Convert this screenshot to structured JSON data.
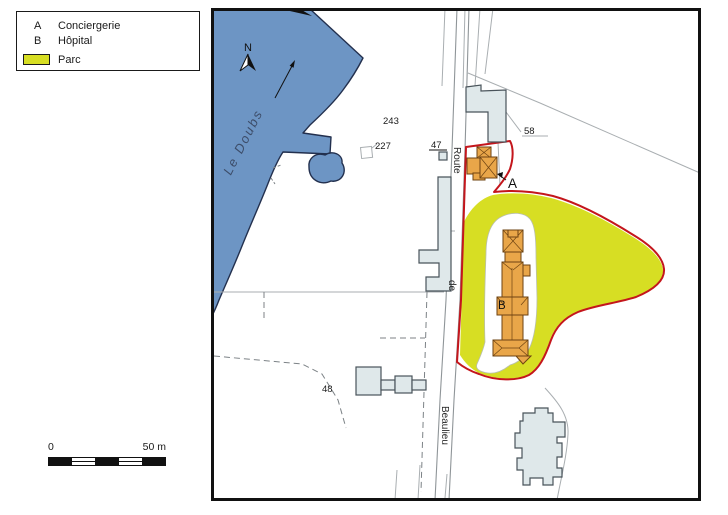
{
  "legend": {
    "items": [
      {
        "key": "A",
        "label": "Conciergerie"
      },
      {
        "key": "B",
        "label": "Hôpital"
      }
    ],
    "parc": {
      "label": "Parc"
    }
  },
  "scale_bar": {
    "start": "0",
    "end": "50 m"
  },
  "map": {
    "north_label": "N",
    "river_label": "Le Doubs",
    "road_labels": {
      "route": "Route",
      "de": "de",
      "beaulieu": "Beaulieu"
    },
    "parcel_numbers": {
      "p243": "243",
      "p227": "227",
      "p47": "47",
      "p58": "58",
      "p48": "48"
    },
    "markers": {
      "a": "A",
      "b": "B"
    },
    "colors": {
      "river": "#6d95c4",
      "river_outline": "#23304e",
      "park": "#d7de23",
      "park_border": "#c4161c",
      "building": "#e9a649",
      "building_outline": "#6e4312",
      "gray_building": "#dfe8ea",
      "gray_building_outline": "#49535a",
      "parcel_line": "#a9aeb1",
      "dashed_line": "#7c8286",
      "road_line": "#8f9598",
      "river_label": "#3c4c68"
    }
  }
}
